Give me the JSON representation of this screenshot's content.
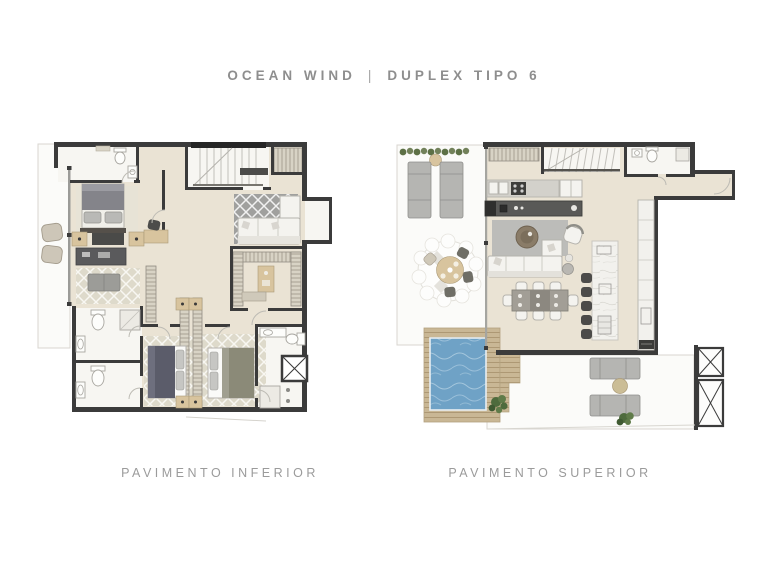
{
  "header": {
    "project": "OCEAN WIND",
    "separator": "|",
    "unit": "DUPLEX TIPO 6"
  },
  "plans": [
    {
      "id": "lower",
      "label": "PAVIMENTO INFERIOR"
    },
    {
      "id": "upper",
      "label": "PAVIMENTO SUPERIOR"
    }
  ],
  "colors": {
    "title_text": "#8e8e8e",
    "label_text": "#9b9b9b",
    "wall": "#3b3b3b",
    "floor_beige": "#eae3d4",
    "floor_white": "#f7f6f2",
    "terrace_white": "#fbfbf9",
    "rug_gray": "#a0a09e",
    "rug_light": "#dedacb",
    "pool_water": "#6fa2c6",
    "deck_wood": "#c9b795",
    "furniture_white": "#f4f3ef",
    "furniture_gray": "#b5b5b2",
    "furniture_dark": "#4c4c4a",
    "furniture_wood": "#d8c49e",
    "bed_gray": "#84848a",
    "bed_navy": "#5b5c6a",
    "bed_olive": "#8b8a78",
    "marble": "#f2f1ed",
    "plant_green": "#4e6b3d",
    "hedge_green": "#5d7046"
  }
}
